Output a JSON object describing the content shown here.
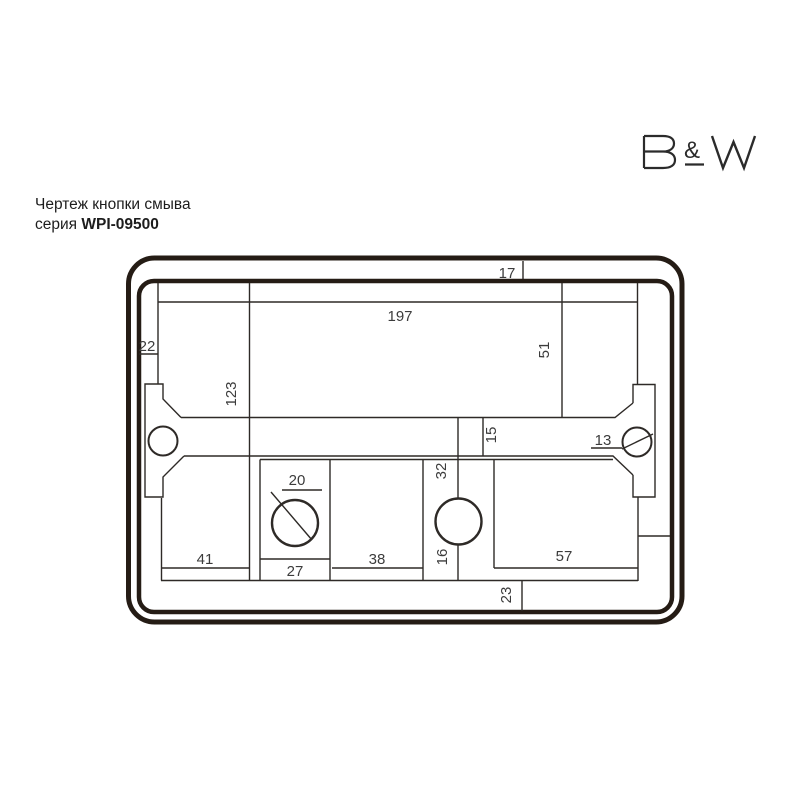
{
  "header": {
    "title": "Чертеж кнопки смыва",
    "series_label": "серия ",
    "series_value": "WPI-09500"
  },
  "logo": {
    "name": "B&W",
    "letter_b": "B",
    "ampersand": "&",
    "letter_w": "W"
  },
  "drawing": {
    "type": "technical-drawing-flush-button-plate",
    "labels": [
      {
        "id": "dim-17",
        "value": "17"
      },
      {
        "id": "dim-197",
        "value": "197"
      },
      {
        "id": "dim-22",
        "value": "22"
      },
      {
        "id": "dim-51",
        "value": "51"
      },
      {
        "id": "dim-123",
        "value": "123"
      },
      {
        "id": "dim-15",
        "value": "15"
      },
      {
        "id": "dim-13",
        "value": "13"
      },
      {
        "id": "dim-20",
        "value": "20"
      },
      {
        "id": "dim-32",
        "value": "32"
      },
      {
        "id": "dim-41",
        "value": "41"
      },
      {
        "id": "dim-27",
        "value": "27"
      },
      {
        "id": "dim-38",
        "value": "38"
      },
      {
        "id": "dim-16",
        "value": "16"
      },
      {
        "id": "dim-57",
        "value": "57"
      },
      {
        "id": "dim-23",
        "value": "23"
      }
    ]
  },
  "colors": {
    "frame": "#251c15",
    "thin_line": "#2e2a27",
    "dimension_text": "#3c3c3c",
    "header_text": "#1d1d1d",
    "logo": "#2b2b2b",
    "background": "#ffffff"
  }
}
